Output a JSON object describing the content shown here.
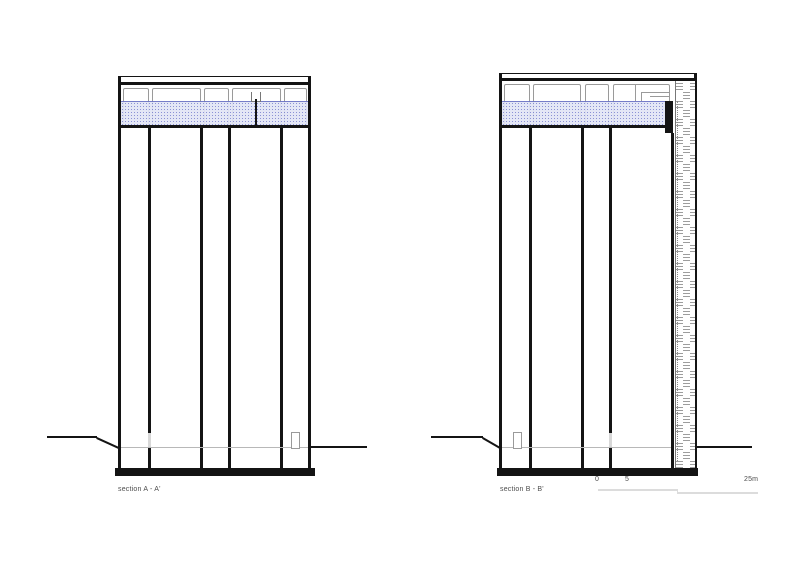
{
  "sections": [
    {
      "label": "section A - A'"
    },
    {
      "label": "section B - B'"
    }
  ],
  "scale_bar": {
    "tick_start": "0",
    "tick_mid": "5",
    "tick_end": "25m"
  },
  "colors": {
    "ink": "#141414",
    "thin_line": "#9a9a9a",
    "band_fill": "#e2e5f6",
    "band_dot": "#8289d2",
    "band_border": "#6b72c4",
    "facade_stripe": "#9d9d9d",
    "ground_line": "#b8b8b8",
    "label_text": "#4d4d4d",
    "scale_line": "#dcdcdc"
  }
}
